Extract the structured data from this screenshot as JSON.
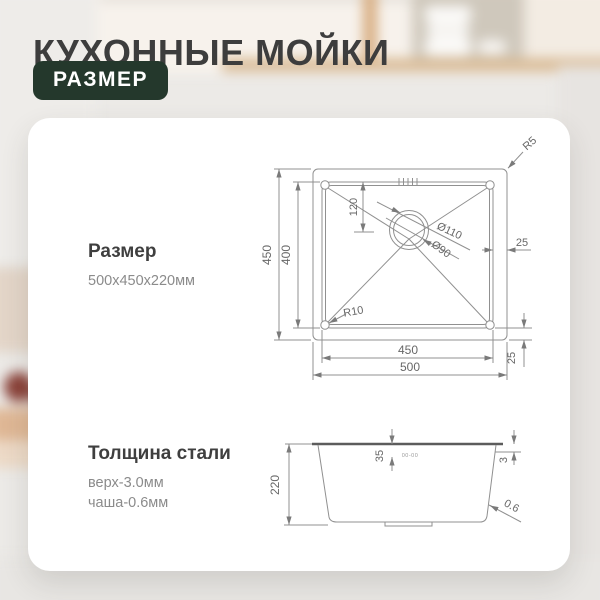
{
  "header": {
    "title": "КУХОННЫЕ МОЙКИ",
    "badge": "РАЗМЕР"
  },
  "card": {
    "size": {
      "heading": "Размер",
      "value": "500х450х220мм"
    },
    "thickness": {
      "heading": "Толщина стали",
      "top": "верх-3.0мм",
      "bowl": "чаша-0.6мм"
    }
  },
  "drawing": {
    "top_view": {
      "outer_width": "500",
      "inner_width": "450",
      "outer_height": "450",
      "inner_height": "400",
      "drain_offset": "120",
      "drain_outer_diameter": "Ø110",
      "drain_inner_diameter": "Ø90",
      "edge_gap_right": "25",
      "edge_gap_bottom": "25",
      "outer_corner_radius": "R5",
      "inner_corner_radius": "R10"
    },
    "side_view": {
      "height": "220",
      "rim_depth": "35",
      "rim_thickness": "3",
      "wall_thickness": "0.6",
      "stamp_mark": "00-00"
    }
  },
  "colors": {
    "badge_background": "#24382c",
    "badge_text": "#ffffff",
    "title_text": "#3d3d3d",
    "card_background": "#ffffff",
    "drawing_lines": "#909090",
    "dimension_text": "#676767"
  }
}
